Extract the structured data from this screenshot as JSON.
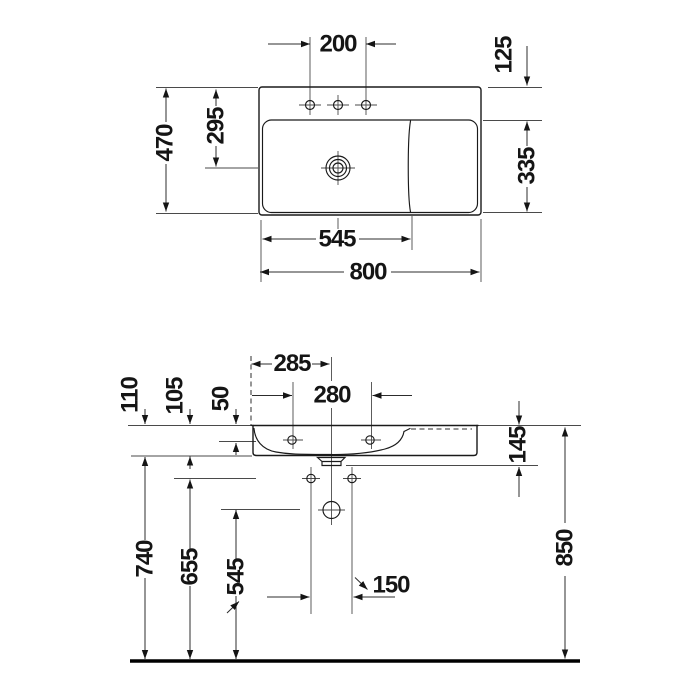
{
  "drawing": {
    "product": "wall-mounted washbasin dimension drawing",
    "views": {
      "top_view_name": "plan view",
      "front_view_name": "front elevation"
    },
    "dims": {
      "top": {
        "faucet_holes": "200",
        "edge_to_basin": "125",
        "depth": "470",
        "back_to_drain": "295",
        "basin_depth": "335",
        "basin_width": "545",
        "width": "800"
      },
      "front": {
        "left_to_drain": "285",
        "fixing_holes": "280",
        "ceramic_h1": "110",
        "ceramic_h2": "105",
        "deck_h": "50",
        "right_body_h": "145",
        "rim_height": "850",
        "underside_height": "740",
        "hole_height": "655",
        "outlet_height": "545",
        "lower_holes": "150"
      }
    }
  }
}
